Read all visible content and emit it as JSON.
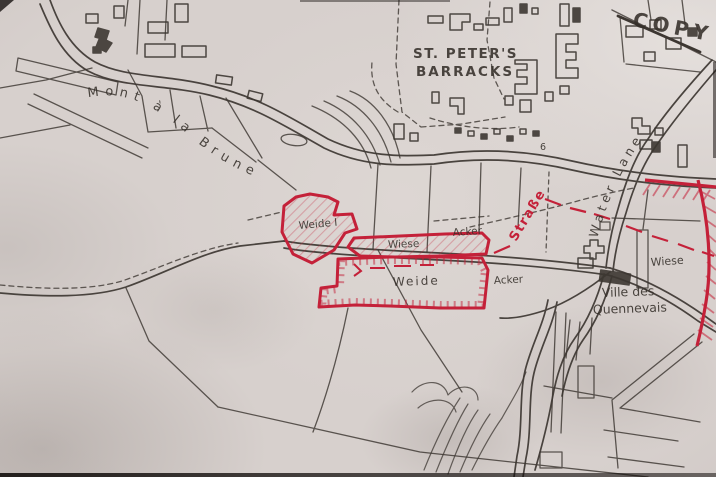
{
  "map": {
    "stamp": "COPY",
    "labels": {
      "barracks_line1": "ST. PETER'S",
      "barracks_line2": "BARRACKS",
      "road_mont": "Mont à la Brune",
      "water_lane": "Water Lane",
      "strasse": "Straße",
      "ville_line1": "Ville des",
      "ville_line2": "Quennevais",
      "weide1": "Weide I",
      "wiese_strip": "Wiese",
      "weide_main": "Weide",
      "acker_north": "Acker",
      "acker_south": "Acker",
      "wiese_east": "Wiese",
      "house_number": "6"
    },
    "colors": {
      "paper": "#d4cdca",
      "pencil": "#3d3732",
      "red": "#c42139"
    }
  }
}
